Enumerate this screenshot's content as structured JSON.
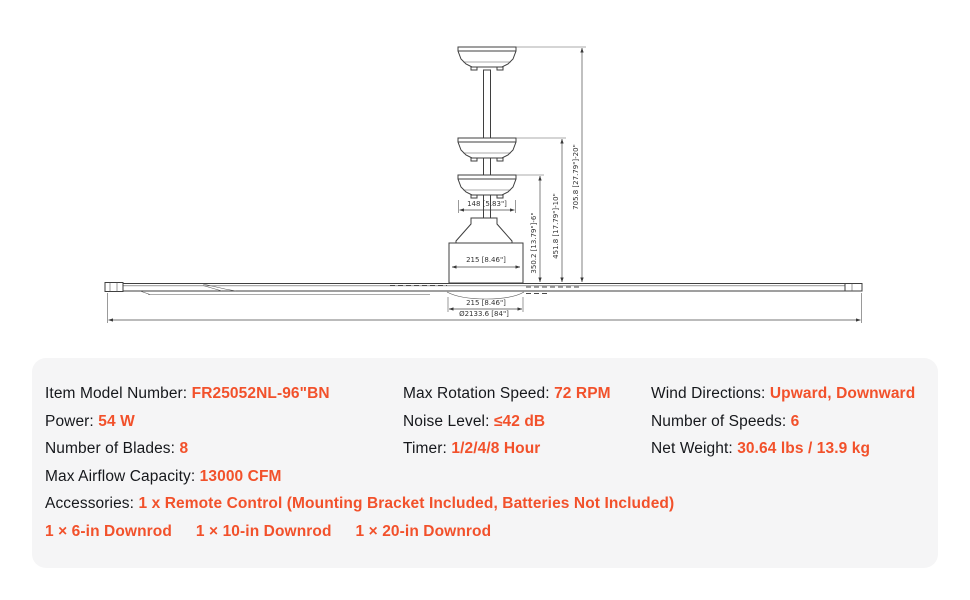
{
  "colors": {
    "accent_value_text": "#f2512b",
    "label_text": "#16181c",
    "panel_background": "#f5f5f6",
    "drawing_lines": "#3f3f3f",
    "page_background": "#ffffff"
  },
  "diagram": {
    "dims": {
      "canopy_width": "148 [5.83\"]",
      "motor_width": "215 [8.46\"]",
      "bottom_width": "215 [8.46\"]",
      "blade_diameter": "Ø2133.6 [84\"]",
      "height_6in": "350.2 [13.79\"]-6\"",
      "height_10in": "451.8 [17.79\"]-10\"",
      "height_20in": "705.8 [27.79\"]-20\""
    }
  },
  "specs": {
    "col1": [
      {
        "label": "Item Model Number: ",
        "value": "FR25052NL-96\"BN"
      },
      {
        "label": "Power: ",
        "value": "54 W"
      },
      {
        "label": "Number of Blades: ",
        "value": "8"
      },
      {
        "label": "Max Airflow Capacity: ",
        "value": "13000 CFM"
      }
    ],
    "col2": [
      {
        "label": "Max Rotation Speed: ",
        "value": "72 RPM"
      },
      {
        "label": "Noise Level: ",
        "value": "≤42 dB"
      },
      {
        "label": "Timer: ",
        "value": "1/2/4/8 Hour"
      }
    ],
    "col3": [
      {
        "label": "Wind Directions: ",
        "value": "Upward, Downward"
      },
      {
        "label": "Number of Speeds: ",
        "value": "6"
      },
      {
        "label": "Net Weight: ",
        "value": "30.64 lbs / 13.9 kg"
      }
    ],
    "accessories": {
      "label": "Accessories: ",
      "value": "1 x Remote Control (Mounting Bracket Included, Batteries Not Included)"
    },
    "downrods": [
      "1 × 6-in Downrod",
      "1 × 10-in Downrod",
      "1 × 20-in Downrod"
    ]
  }
}
